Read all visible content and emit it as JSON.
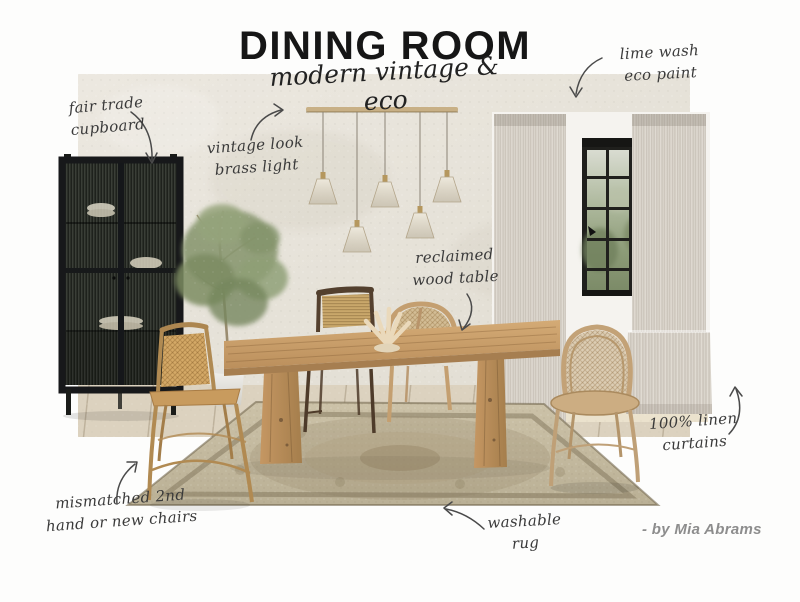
{
  "title": "DINING ROOM",
  "subtitle": "modern vintage & eco",
  "credit": "- by Mia Abrams",
  "annotations": {
    "cupboard": {
      "line1": "fair trade",
      "line2": "cupboard"
    },
    "light": {
      "line1": "vintage look",
      "line2": "brass light"
    },
    "paint": {
      "line1": "lime wash",
      "line2": "eco paint"
    },
    "table": {
      "line1": "reclaimed",
      "line2": "wood table"
    },
    "curtains": {
      "line1": "100% linen",
      "line2": "curtains"
    },
    "chairs": {
      "line1": "mismatched 2nd",
      "line2": "hand or new chairs"
    },
    "rug": {
      "line1": "washable",
      "line2": "rug"
    }
  },
  "palette": {
    "page_bg": "#fdfdfc",
    "plaster_wall": "#e7e3da",
    "annotation_ink": "#3a3a3a",
    "title_ink": "#161616",
    "credit_gray": "#8d8d8d",
    "cabinet_black": "#22251f",
    "wood_tan": "#c69f6a",
    "curtain_greige": "#d5cfc5",
    "rug_beige": "#c4b99f",
    "olive_green": "#83926b",
    "brass": "#c8b086"
  }
}
